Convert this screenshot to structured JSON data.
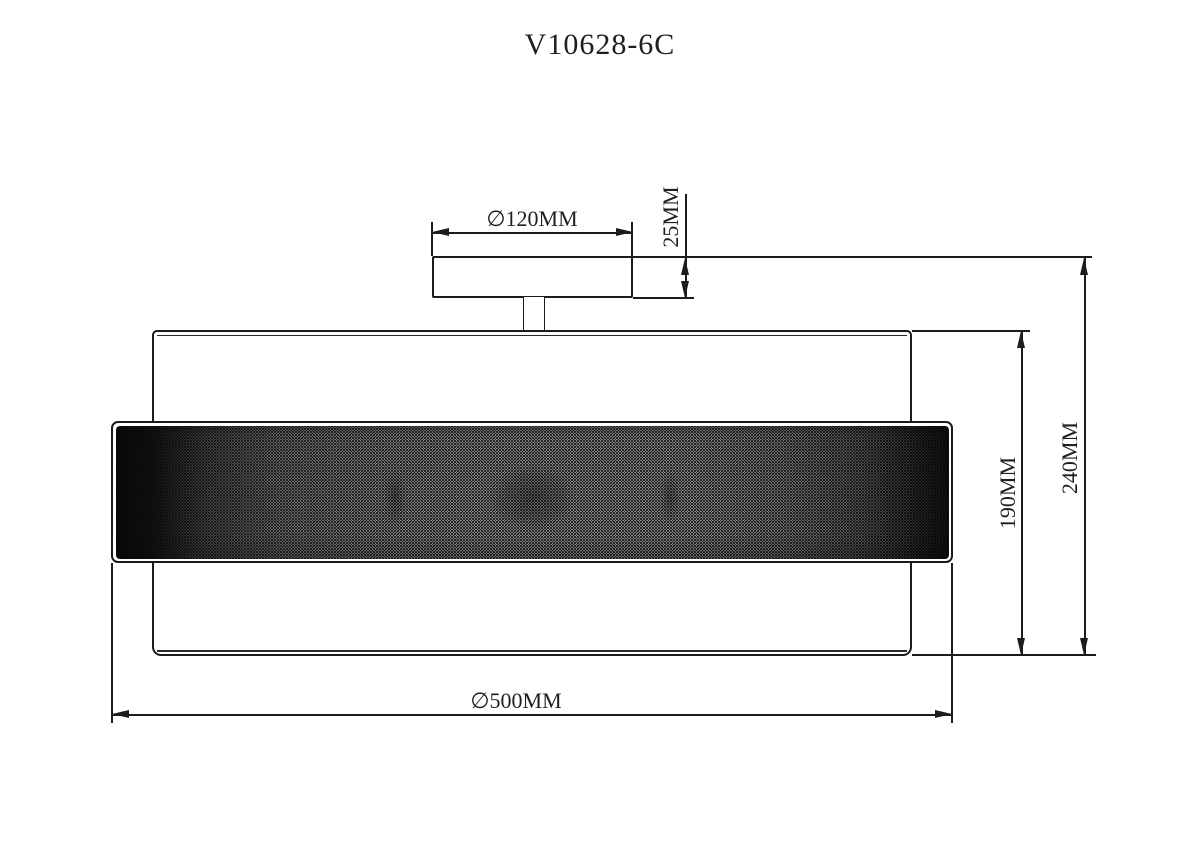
{
  "title": "V10628-6C",
  "labels": {
    "canopy_diameter": "∅120MM",
    "canopy_height": "25MM",
    "shade_height": "190MM",
    "overall_height": "240MM",
    "shade_diameter": "∅500MM"
  },
  "colors": {
    "line": "#1c1c1c",
    "background": "#ffffff",
    "mesh_light": "#e3e3e3",
    "mesh_dark": "#050505"
  }
}
